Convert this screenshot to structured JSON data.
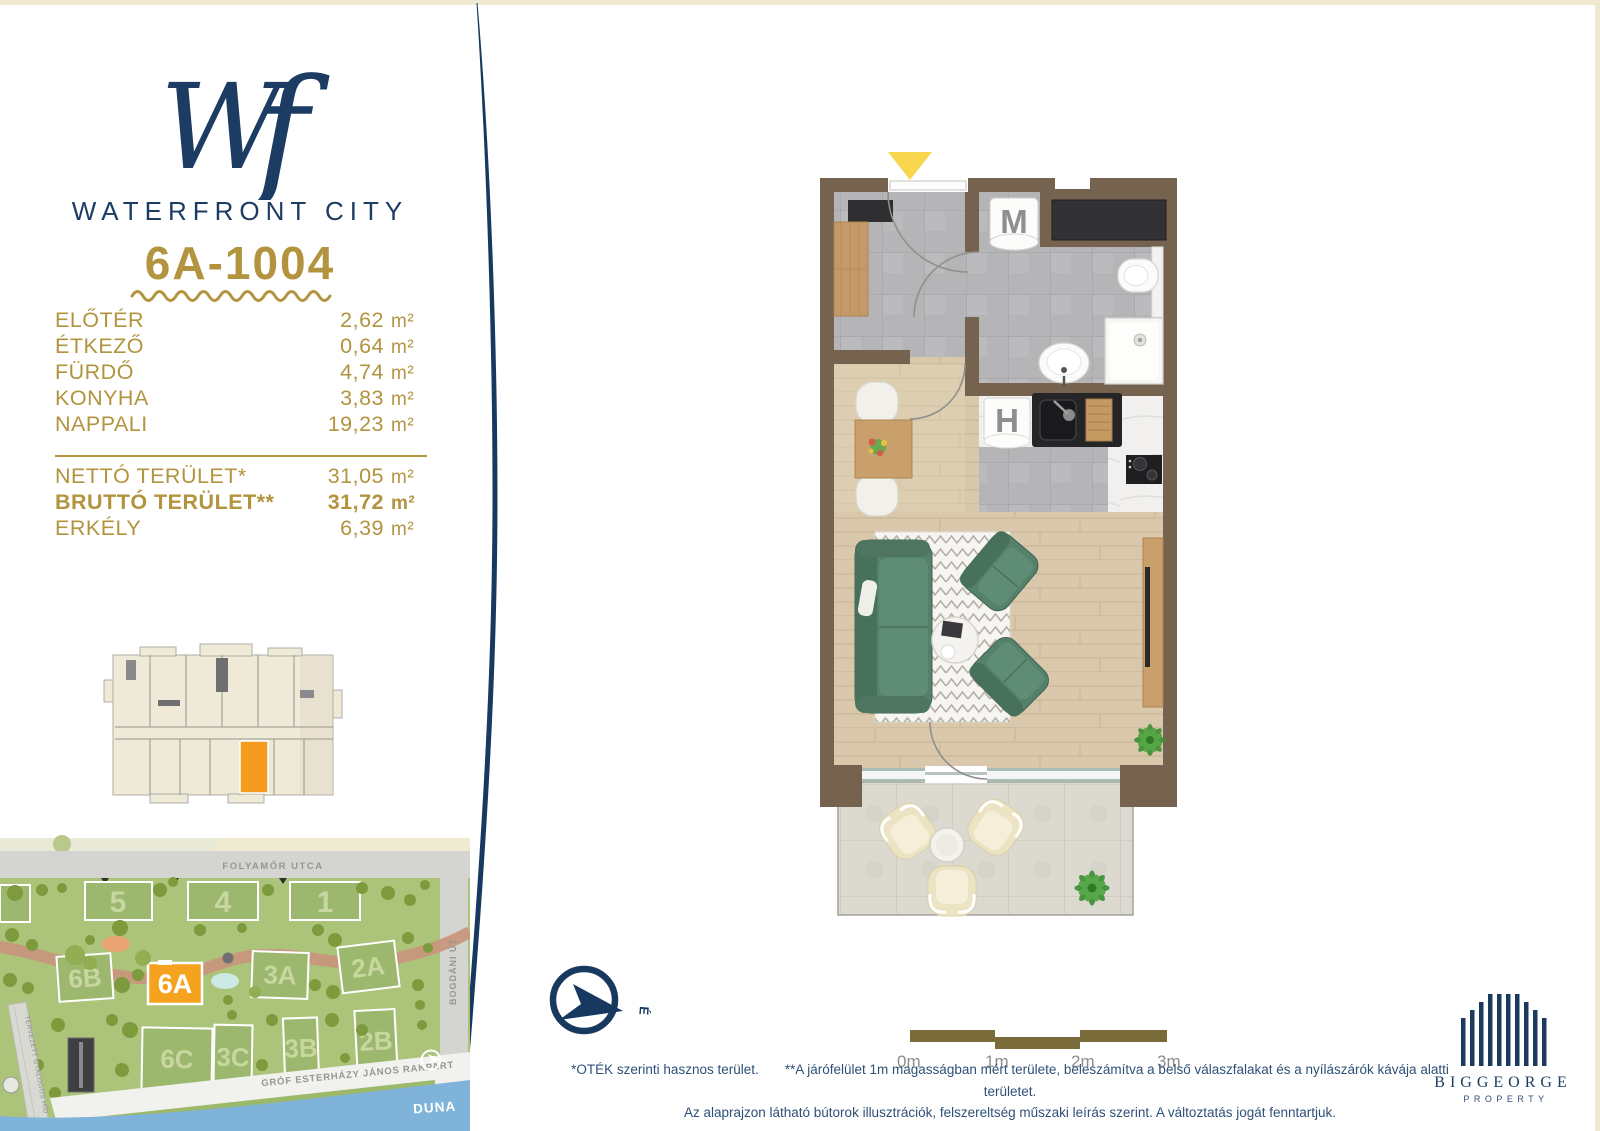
{
  "brand": {
    "monogram_w": "W",
    "monogram_f": "f",
    "name": "WATERFRONT CITY"
  },
  "unit": {
    "id": "6A-1004"
  },
  "rooms": [
    {
      "label": "ELŐTÉR",
      "value": "2,62",
      "unit": "m²"
    },
    {
      "label": "ÉTKEZŐ",
      "value": "0,64",
      "unit": "m²"
    },
    {
      "label": "FÜRDŐ",
      "value": "4,74",
      "unit": "m²"
    },
    {
      "label": "KONYHA",
      "value": "3,83",
      "unit": "m²"
    },
    {
      "label": "NAPPALI",
      "value": "19,23",
      "unit": "m²"
    }
  ],
  "totals": [
    {
      "label": "NETTÓ TERÜLET*",
      "value": "31,05",
      "unit": "m²"
    },
    {
      "label": "BRUTTÓ TERÜLET**",
      "value": "31,72",
      "unit": "m²"
    },
    {
      "label": "ERKÉLY",
      "value": "6,39",
      "unit": "m²"
    }
  ],
  "floor_plan": {
    "washer_label": "M",
    "fridge_label": "H"
  },
  "compass": {
    "north_label": "É"
  },
  "scale_bar": {
    "labels": [
      "0m",
      "1m",
      "2m",
      "3m"
    ]
  },
  "site_map": {
    "streets": {
      "folyamor": "FOLYAMŐR UTCA",
      "rakpart": "GRÓF ESTERHÁZY JÁNOS RAKPART",
      "bogdani": "BOGDÁNI ÚT"
    },
    "river": "DUNA",
    "bridge": "TERVEZETT GYALOGOS HÍD",
    "highlighted_building": "6A",
    "buildings": [
      "5",
      "4",
      "1",
      "6B",
      "6A",
      "3A",
      "2A",
      "6C",
      "3C",
      "3B",
      "2B"
    ]
  },
  "footer": {
    "note1": "*OTÉK szerinti hasznos terület.",
    "note2": "**A járófelület 1m magasságban mért területe, beleszámítva a belső válaszfalakat és a nyílászárók kávája alatti területet.",
    "line2": "Az alaprajzon látható bútorok illusztrációk, felszereltség műszaki leírás szerint. A változtatás jogát fenntartjuk."
  },
  "developer": {
    "name": "BIGGEORGE",
    "division": "PROPERTY"
  },
  "colors": {
    "accent_gold": "#b2933e",
    "navy": "#1d3c63",
    "highlight_orange": "#f5a21f"
  }
}
